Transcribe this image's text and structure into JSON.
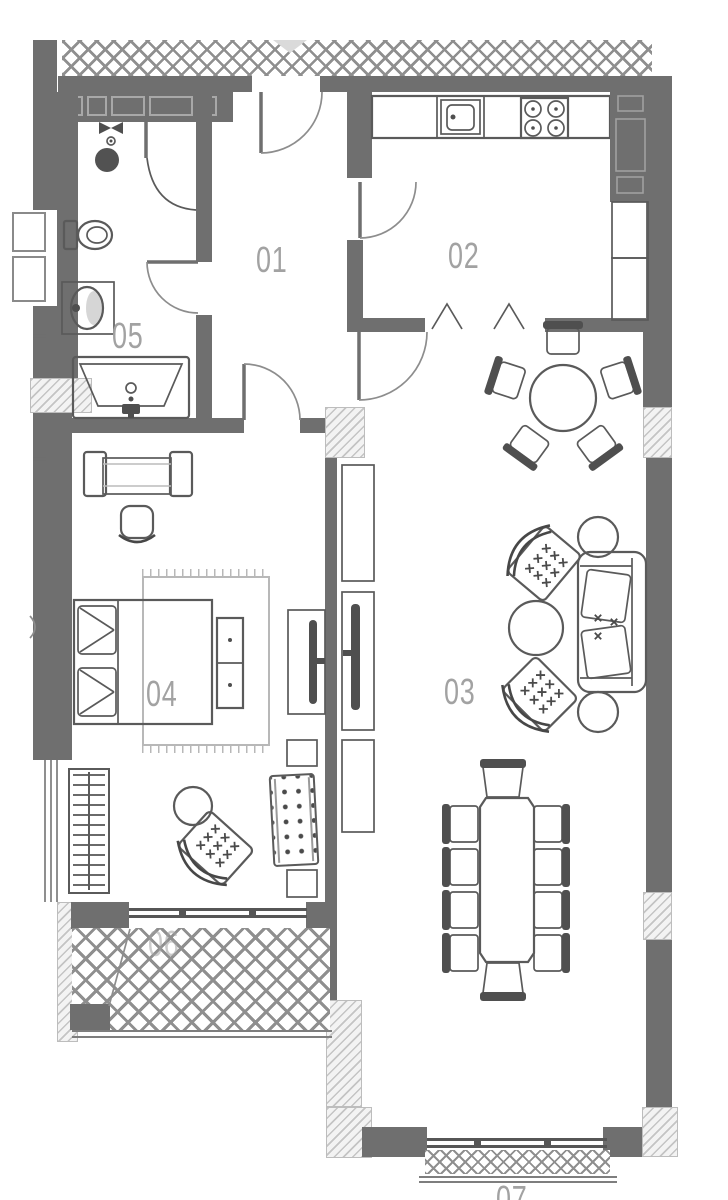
{
  "plan": {
    "rooms": [
      {
        "number": "01"
      },
      {
        "number": "02"
      },
      {
        "number": "03"
      },
      {
        "number": "04"
      },
      {
        "number": "05"
      },
      {
        "number": "06"
      },
      {
        "number": "07"
      }
    ],
    "colors": {
      "wall": "#6f6f6f",
      "furniture_line": "#5a5a5a",
      "accent_dark": "#4a4a4a",
      "room_label": "#a2a2a2",
      "crosshatch_line": "#8f8f8f",
      "column_hatch_line": "#c4c4c4",
      "background": "#ffffff"
    }
  }
}
